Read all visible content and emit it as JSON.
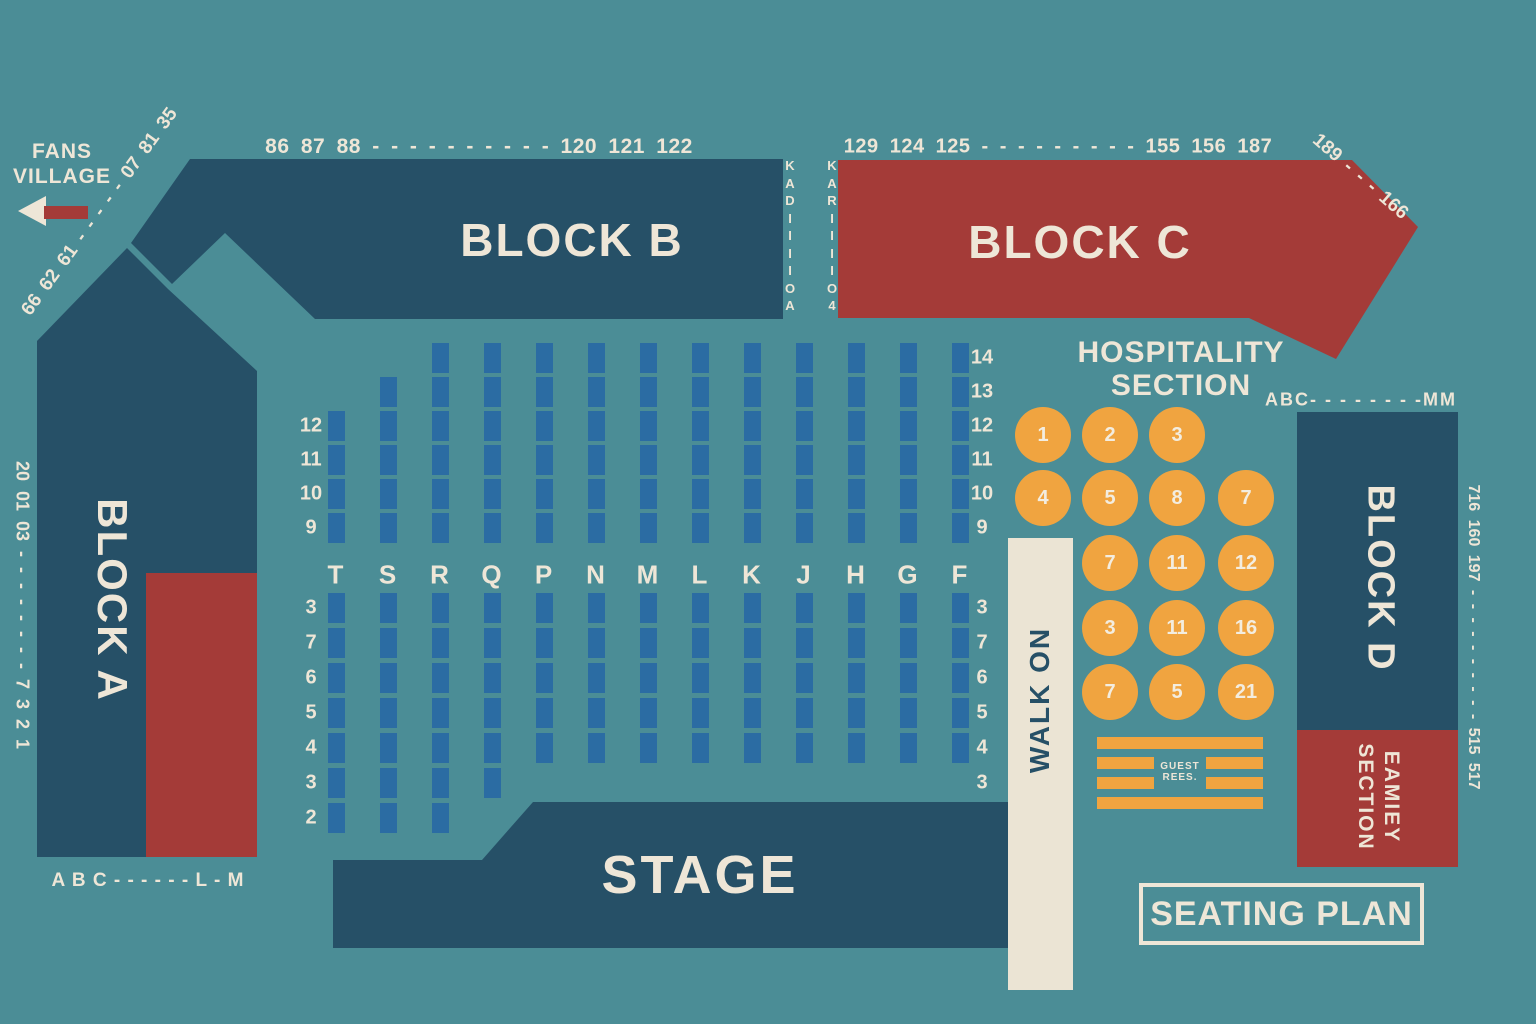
{
  "colors": {
    "background": "#4B8D96",
    "block_dark": "#265067",
    "block_red": "#A43B38",
    "cream": "#EEE6D7",
    "seat_blue": "#2B6CA3",
    "orange": "#F0A440"
  },
  "fans_village": {
    "line1": "FANS",
    "line2": "VILLAGE"
  },
  "blocks": {
    "a": "BLOCK A",
    "b": "BLOCK B",
    "c": "BLOCK C",
    "d": "BLOCK D",
    "stage": "STAGE",
    "walk_on": "WALK ON",
    "family_line1": "EAMIEY",
    "family_line2": "SECTION"
  },
  "edge_labels": {
    "top_b": "86 87 88 - - - - - - - - - - 120 121 122",
    "top_c": "129 124 125 - - - - - - - - - 155 156 187",
    "diag_c": "189 - - - 166",
    "diag_a": "66 62 61 - - - - - 07 81 35",
    "left_vertical": "20 01 03 - - - - - - - - 7 3 2 1",
    "right_vertical": "716 160 197 - - - - - - - - - - 515 517",
    "block_d_top": "ABC- - - - - - - -MM",
    "block_a_bottom": "A B C - - - - - - L - M",
    "aisle_column_1": [
      "K",
      "A",
      "D",
      "I",
      "I",
      "I",
      "I",
      "O",
      "A"
    ],
    "aisle_column_2": [
      "K",
      "A",
      "R",
      "I",
      "I",
      "I",
      "I",
      "O",
      "4"
    ]
  },
  "hospitality": {
    "title_line1": "HOSPITALITY",
    "title_line2": "SECTION",
    "cols_x": [
      1043,
      1110,
      1177,
      1246
    ],
    "rows_y": [
      435,
      498,
      563,
      628,
      692
    ],
    "circles": [
      {
        "c": 0,
        "r": 0,
        "t": "1"
      },
      {
        "c": 1,
        "r": 0,
        "t": "2"
      },
      {
        "c": 2,
        "r": 0,
        "t": "3"
      },
      {
        "c": 0,
        "r": 1,
        "t": "4"
      },
      {
        "c": 1,
        "r": 1,
        "t": "5"
      },
      {
        "c": 2,
        "r": 1,
        "t": "8"
      },
      {
        "c": 3,
        "r": 1,
        "t": "7"
      },
      {
        "c": 1,
        "r": 2,
        "t": "7"
      },
      {
        "c": 2,
        "r": 2,
        "t": "11"
      },
      {
        "c": 3,
        "r": 2,
        "t": "12"
      },
      {
        "c": 1,
        "r": 3,
        "t": "3"
      },
      {
        "c": 2,
        "r": 3,
        "t": "11"
      },
      {
        "c": 3,
        "r": 3,
        "t": "16"
      },
      {
        "c": 1,
        "r": 4,
        "t": "7"
      },
      {
        "c": 2,
        "r": 4,
        "t": "5"
      },
      {
        "c": 3,
        "r": 4,
        "t": "21"
      }
    ]
  },
  "guest_box": {
    "line1": "GUEST",
    "line2": "REES."
  },
  "seating_plan_label": "SEATING PLAN",
  "seat_grid": {
    "columns": [
      {
        "letter": "T",
        "upper": 4,
        "lower": 7
      },
      {
        "letter": "S",
        "upper": 5,
        "lower": 7
      },
      {
        "letter": "R",
        "upper": 6,
        "lower": 7
      },
      {
        "letter": "Q",
        "upper": 6,
        "lower": 6
      },
      {
        "letter": "P",
        "upper": 6,
        "lower": 5
      },
      {
        "letter": "N",
        "upper": 6,
        "lower": 5
      },
      {
        "letter": "M",
        "upper": 6,
        "lower": 5
      },
      {
        "letter": "L",
        "upper": 6,
        "lower": 5
      },
      {
        "letter": "K",
        "upper": 6,
        "lower": 5
      },
      {
        "letter": "J",
        "upper": 6,
        "lower": 5
      },
      {
        "letter": "H",
        "upper": 6,
        "lower": 5
      },
      {
        "letter": "G",
        "upper": 6,
        "lower": 5
      },
      {
        "letter": "F",
        "upper": 6,
        "lower": 5
      }
    ],
    "left_labels_upper": [
      "12",
      "11",
      "10",
      "9"
    ],
    "left_labels_lower": [
      "3",
      "7",
      "6",
      "5",
      "4",
      "3",
      "2"
    ],
    "right_labels_upper": [
      "14",
      "13",
      "12",
      "11",
      "10",
      "9"
    ],
    "right_labels_lower": [
      "3",
      "7",
      "6",
      "5",
      "4",
      "3"
    ]
  }
}
